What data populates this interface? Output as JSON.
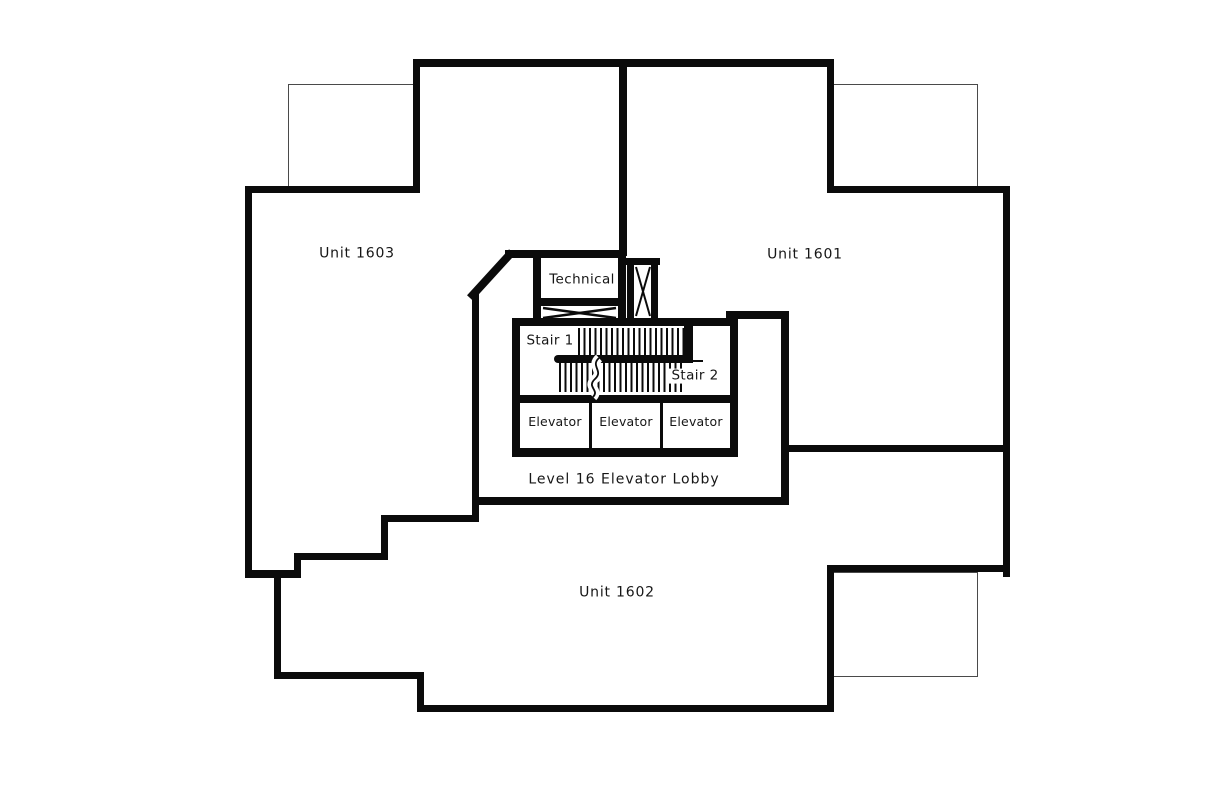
{
  "colors": {
    "background": "#ffffff",
    "wall": "#0b0b0b",
    "thin_line": "#4a4a4a",
    "text": "#161616"
  },
  "floorplan": {
    "units": [
      {
        "label": "Unit 1603"
      },
      {
        "label": "Unit 1601"
      },
      {
        "label": "Unit 1602"
      }
    ],
    "core": {
      "technical": "Technical",
      "stair1": "Stair 1",
      "stair2": "Stair 2",
      "elevators": [
        "Elevator",
        "Elevator",
        "Elevator"
      ],
      "lobby": "Level 16 Elevator Lobby"
    }
  }
}
